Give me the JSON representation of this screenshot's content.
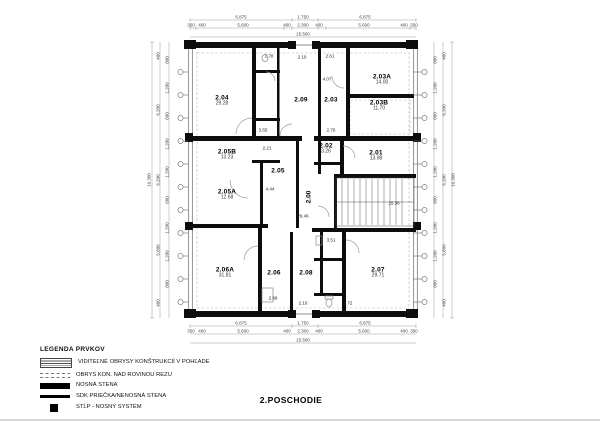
{
  "title": "2.POSCHODIE",
  "legend": {
    "title": "LEGENDA PRVKOV",
    "items": [
      {
        "label": "VIDITEĽNÉ OBRYSY KONŠTRUKCIÍ V POHĽADE"
      },
      {
        "label": "OBRYS KON. NAD ROVINOU REZU"
      },
      {
        "label": "NOSNÁ STENA"
      },
      {
        "label": "SDK PRIEČKA/NENOSNÁ STENA"
      },
      {
        "label": "STĹP - NOSNÝ SYSTÉM"
      }
    ]
  },
  "rooms": [
    {
      "id": "2.04",
      "area": "29.28"
    },
    {
      "id": "2.09",
      "area": ""
    },
    {
      "id": "2.03",
      "area": ""
    },
    {
      "id": "2.03A",
      "area": "14.00"
    },
    {
      "id": "2.03B",
      "area": "11.70"
    },
    {
      "id": "2.02",
      "area": "3.26"
    },
    {
      "id": "2.01",
      "area": "13.98"
    },
    {
      "id": "2.05B",
      "area": "13.23"
    },
    {
      "id": "2.05A",
      "area": "12.68"
    },
    {
      "id": "2.05",
      "area": "4.44"
    },
    {
      "id": "2.06A",
      "area": "31.81"
    },
    {
      "id": "2.06",
      "area": ""
    },
    {
      "id": "2.08",
      "area": ""
    },
    {
      "id": "2.07",
      "area": "29.71"
    }
  ],
  "corridor": {
    "id": "2.00",
    "area": "29.46"
  },
  "stairs": {
    "area": "15.36"
  },
  "annotations": [
    "1.78",
    "2.10",
    "2.61",
    "4.07",
    "3.55",
    "2.21",
    "2.76",
    "3.51",
    "2.99",
    "2.10",
    "1.72"
  ],
  "dimensions": {
    "top": {
      "row1": [
        "6.875",
        "1.750",
        "6.875"
      ],
      "row2": [
        "350",
        "400",
        "5.600",
        "400",
        "2.300",
        "400",
        "5.600",
        "400",
        "350"
      ],
      "total": "15.500"
    },
    "side": {
      "total": "19.300",
      "chain": [
        "400",
        "6.200",
        "6.200",
        "5.600",
        "400"
      ],
      "window_module": [
        "800",
        "1.200",
        "600",
        "1.200",
        "1.200",
        "600",
        "1.200",
        "1.200",
        "800"
      ]
    }
  },
  "colors": {
    "wall": "#0d0d0d",
    "thin_line": "#777777",
    "dash_line": "#aaaaaa"
  }
}
